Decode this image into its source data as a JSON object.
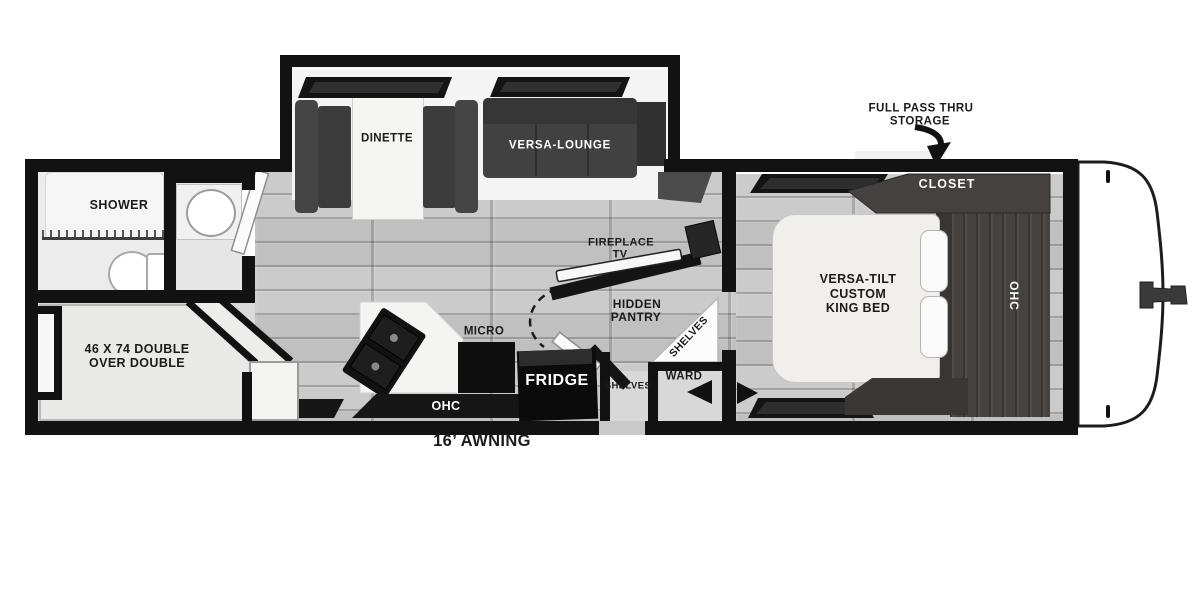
{
  "colors": {
    "wall": "#121212",
    "floor_plank": "#c5c5c5",
    "dark_wood": "#454140",
    "sofa": "#414141",
    "white": "#ffffff"
  },
  "slideout": {
    "dinette": "DINETTE",
    "versa_lounge": "VERSA-LOUNGE"
  },
  "bathroom": {
    "shower": "SHOWER"
  },
  "bunk_room": {
    "line1": "46 X 74 DOUBLE",
    "line2": "OVER DOUBLE"
  },
  "kitchen": {
    "micro": "MICRO",
    "fridge": "FRIDGE",
    "ohc": "OHC"
  },
  "living": {
    "fireplace_line1": "FIREPLACE",
    "fireplace_line2": "TV"
  },
  "pantry": {
    "line1": "HIDDEN",
    "line2": "PANTRY",
    "corner_shelves": "SHELVES",
    "entry_shelves": "SHELVES",
    "ward": "WARD"
  },
  "bedroom": {
    "bed_line1": "VERSA-TILT",
    "bed_line2": "CUSTOM",
    "bed_line3": "KING BED",
    "closet": "CLOSET",
    "ohc": "OHC"
  },
  "exterior": {
    "storage_line1": "FULL PASS THRU",
    "storage_line2": "STORAGE",
    "awning": "16’ AWNING"
  }
}
